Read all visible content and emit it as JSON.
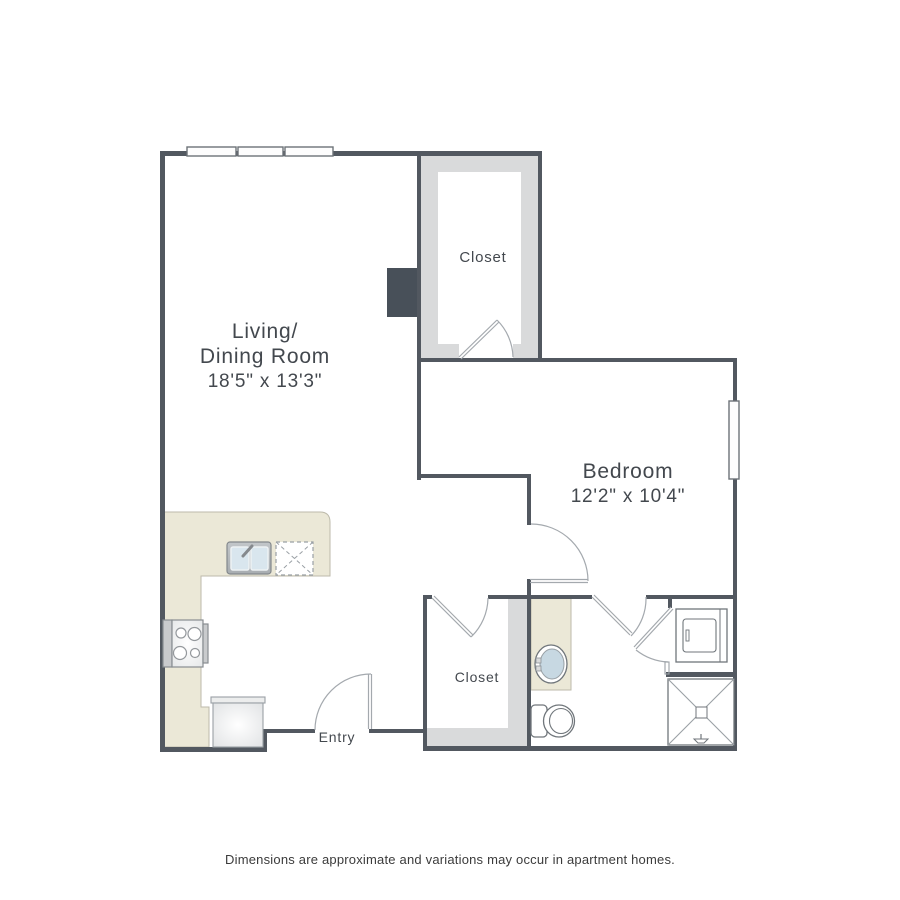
{
  "floorplan": {
    "living": {
      "name_line1": "Living/",
      "name_line2": "Dining Room",
      "dimensions": "18'5\" x 13'3\""
    },
    "bedroom": {
      "name": "Bedroom",
      "dimensions": "12'2\" x 10'4\""
    },
    "walk_in_closet": {
      "name": "Closet"
    },
    "entry_closet": {
      "name": "Closet"
    },
    "entry": {
      "name": "Entry"
    }
  },
  "footer": {
    "disclaimer": "Dimensions are approximate and variations may occur in apartment homes."
  },
  "colors": {
    "wall": "#525860",
    "light_wall": "#d9dadb",
    "counter": "#ebe8d7",
    "sink_water": "#c7d8e2",
    "background": "#ffffff"
  },
  "fixtures": [
    "kitchen-sink",
    "dishwasher",
    "range",
    "refrigerator",
    "bathroom-vanity-sink",
    "toilet",
    "shower",
    "washer-dryer"
  ]
}
